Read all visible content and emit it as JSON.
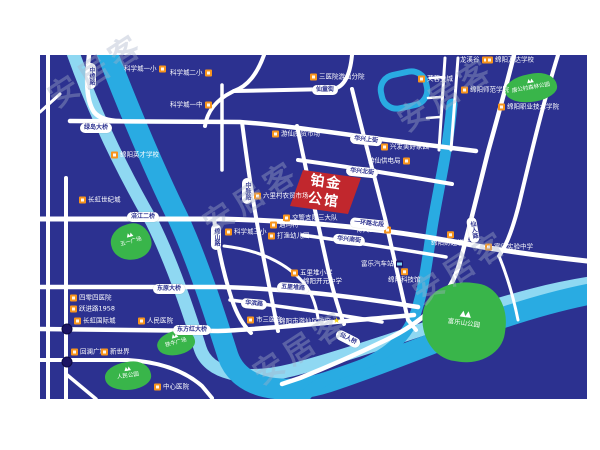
{
  "watermark": {
    "text": "安居客",
    "angle": -33,
    "positions": [
      [
        95,
        68
      ],
      [
        445,
        92
      ],
      [
        250,
        195
      ],
      [
        460,
        265
      ],
      [
        300,
        345
      ]
    ]
  },
  "project": {
    "line1": "铂金",
    "line2": "公馆",
    "color": "#C1272D",
    "points": "303,170 361,178 348,214 290,206",
    "cx": 325,
    "cy": 192,
    "rotate": 8
  },
  "map": {
    "colors": {
      "bg": "#2C3190",
      "road": "#FFFFFF",
      "river": "#29ABE2",
      "river_light": "#8FD8F2",
      "park": "#39B54A",
      "poi_icon": "#F7941D",
      "marker_dot": "#1B1464",
      "project_red": "#C1272D",
      "pill_text": "#2C3190",
      "star": "#F7D51D"
    },
    "rivers": [
      {
        "name": "涪江浅带",
        "color": "#8FD8F2",
        "w": 13,
        "path": "M 72,50 C 95,115 122,170 152,222 C 170,258 186,303 200,348 C 208,374 244,382 292,370 C 352,354 416,331 478,311 C 518,298 552,289 590,283"
      },
      {
        "name": "涪江",
        "color": "#29ABE2",
        "w": 21,
        "path": "M 106,50 C 130,112 152,165 178,218 C 198,262 214,312 228,356 C 240,390 284,396 328,382 C 380,365 434,342 490,322 C 530,308 560,300 590,294"
      },
      {
        "name": "芙蓉溪",
        "color": "#29ABE2",
        "w": 11,
        "path": "M 452,104 C 448,150 438,190 432,228 C 427,262 424,288 416,312 C 405,344 378,360 344,372 C 322,380 308,390 303,400"
      }
    ],
    "lake": {
      "cx": 404,
      "cy": 90,
      "w": 46,
      "h": 34,
      "rx": 15,
      "rotate": -12,
      "stroke": "#29ABE2",
      "sw": 6
    },
    "roads": [
      {
        "name": "滨江纵路",
        "w": 4,
        "path": "M 48,55 V 399"
      },
      {
        "name": "临园纵路",
        "w": 4,
        "path": "M 66,178 V 399"
      },
      {
        "name": "左上斜路",
        "w": 3,
        "path": "M 40,112 L 60,94"
      },
      {
        "name": "中绵路",
        "w": 4.5,
        "path": "M 89,55 C 86,80 86,100 94,112 C 99,118 108,121 120,121"
      },
      {
        "name": "绿岛大桥-华兴上街",
        "w": 4.5,
        "path": "M 70,121 L 240,122 C 280,125 330,132 380,139 C 420,144 452,148 476,151"
      },
      {
        "name": "仙童街西",
        "w": 4,
        "path": "M 264,55 C 257,74 248,86 234,91 L 232,92 C 216,100 207,112 205,126"
      },
      {
        "name": "仙童街东",
        "w": 4,
        "path": "M 234,91 L 332,89 C 344,88 350,76 352,55"
      },
      {
        "name": "科学城纵路",
        "w": 3.5,
        "path": "M 222,85 L 222,170"
      },
      {
        "name": "绵山路",
        "w": 4,
        "path": "M 214,219 C 218,250 224,275 232,300 C 237,315 243,325 251,333"
      },
      {
        "name": "中脉路",
        "w": 4,
        "path": "M 242,122 C 248,170 255,215 263,255 C 268,280 273,305 278,331"
      },
      {
        "name": "项目西路",
        "w": 4,
        "path": "M 297,126 C 306,170 316,215 326,260 C 332,288 338,308 344,324"
      },
      {
        "name": "项目东路",
        "w": 4,
        "path": "M 352,89 C 362,130 374,175 385,218 C 392,248 400,285 408,320 L 416,330"
      },
      {
        "name": "华兴北街",
        "w": 4,
        "path": "M 298,160 C 350,167 405,176 452,184"
      },
      {
        "name": "一环路北段",
        "w": 5,
        "path": "M 40,219 L 222,219 C 310,221 390,229 472,245 C 510,252 550,257 587,261"
      },
      {
        "name": "华兴南街",
        "w": 3.5,
        "path": "M 302,235 C 352,242 400,249 446,257"
      },
      {
        "name": "五里堆路",
        "w": 4.5,
        "path": "M 40,287 L 222,287 C 290,289 350,296 418,307"
      },
      {
        "name": "华滨路",
        "w": 3.5,
        "path": "M 230,300 C 280,306 330,313 382,322"
      },
      {
        "name": "东方红大桥路",
        "w": 4.5,
        "path": "M 40,329 L 218,331 C 270,329 330,322 392,317 L 414,315"
      },
      {
        "name": "滨河南路",
        "w": 4,
        "path": "M 40,360 L 128,360 C 162,362 186,372 202,386 L 212,398"
      },
      {
        "name": "左下斜路",
        "w": 3.5,
        "path": "M 66,374 L 96,399"
      },
      {
        "name": "科三小弯路",
        "w": 3,
        "path": "M 224,246 C 258,250 285,262 303,282 C 312,292 316,305 318,318"
      },
      {
        "name": "仙人路",
        "w": 4.5,
        "path": "M 514,55 C 504,95 494,130 488,152 C 478,192 470,225 460,262 C 450,298 424,320 392,337 C 362,352 330,366 300,378 L 282,384"
      },
      {
        "name": "梯路西",
        "w": 3,
        "path": "M 445,58 L 439,150"
      },
      {
        "name": "梯路东",
        "w": 3,
        "path": "M 458,58 L 451,150"
      },
      {
        "name": "梯横1",
        "w": 2.5,
        "path": "M 430,78 L 444,77"
      },
      {
        "name": "梯横2",
        "w": 2.5,
        "path": "M 428,98 L 442,97"
      },
      {
        "name": "梯横3",
        "w": 2.5,
        "path": "M 427,118 L 440,117"
      },
      {
        "name": "东侧斜路",
        "w": 4,
        "path": "M 558,55 C 544,100 532,150 521,196 C 514,226 507,245 499,256"
      },
      {
        "name": "富乐支路",
        "w": 3,
        "path": "M 499,256 C 508,278 514,300 518,320"
      }
    ],
    "pills": [
      {
        "t": "绿岛大桥",
        "x": 96,
        "y": 128,
        "v": false,
        "a": 0
      },
      {
        "t": "中绵路",
        "x": 91,
        "y": 76,
        "v": true,
        "a": 0
      },
      {
        "t": "仙童街",
        "x": 325,
        "y": 90,
        "v": false,
        "a": 0
      },
      {
        "t": "华兴上街",
        "x": 366,
        "y": 140,
        "v": false,
        "a": 6
      },
      {
        "t": "华兴北街",
        "x": 362,
        "y": 172,
        "v": false,
        "a": 6
      },
      {
        "t": "一环路北段",
        "x": 369,
        "y": 224,
        "v": false,
        "a": 6
      },
      {
        "t": "华兴南街",
        "x": 349,
        "y": 240,
        "v": false,
        "a": 6
      },
      {
        "t": "五里堆路",
        "x": 293,
        "y": 288,
        "v": false,
        "a": 4
      },
      {
        "t": "华滨路",
        "x": 254,
        "y": 304,
        "v": false,
        "a": 5
      },
      {
        "t": "涪江二桥",
        "x": 143,
        "y": 217,
        "v": false,
        "a": 0
      },
      {
        "t": "东原大桥",
        "x": 169,
        "y": 289,
        "v": false,
        "a": 0
      },
      {
        "t": "东方红大桥",
        "x": 192,
        "y": 330,
        "v": false,
        "a": 0
      },
      {
        "t": "绵山路",
        "x": 216,
        "y": 237,
        "v": true,
        "a": 0
      },
      {
        "t": "中脉路",
        "x": 247,
        "y": 191,
        "v": true,
        "a": 0
      },
      {
        "t": "仙人路",
        "x": 473,
        "y": 230,
        "v": true,
        "a": -10
      },
      {
        "t": "仙人桥",
        "x": 348,
        "y": 339,
        "v": false,
        "a": 27
      }
    ],
    "pois": [
      {
        "t": "科学城一小",
        "x": 124,
        "y": 69,
        "side": "right",
        "kind": "orange"
      },
      {
        "t": "科学城二小",
        "x": 170,
        "y": 73,
        "side": "right",
        "kind": "orange"
      },
      {
        "t": "科学城一中",
        "x": 170,
        "y": 105,
        "side": "right",
        "kind": "orange"
      },
      {
        "t": "绵阳英才学校",
        "x": 111,
        "y": 155,
        "side": "left",
        "kind": "orange"
      },
      {
        "t": "长虹世纪城",
        "x": 79,
        "y": 200,
        "side": "left",
        "kind": "orange"
      },
      {
        "t": "四零四医院",
        "x": 70,
        "y": 298,
        "side": "left",
        "kind": "orange"
      },
      {
        "t": "跃进路1958",
        "x": 70,
        "y": 309,
        "side": "left",
        "kind": "orange"
      },
      {
        "t": "长虹国际城",
        "x": 74,
        "y": 321,
        "side": "left",
        "kind": "orange"
      },
      {
        "t": "人民医院",
        "x": 138,
        "y": 321,
        "side": "left",
        "kind": "orange"
      },
      {
        "t": "回澜广场",
        "x": 71,
        "y": 352,
        "side": "left",
        "kind": "orange"
      },
      {
        "t": "新世界",
        "x": 101,
        "y": 352,
        "side": "left",
        "kind": "orange"
      },
      {
        "t": "中心医院",
        "x": 154,
        "y": 387,
        "side": "left",
        "kind": "orange"
      },
      {
        "t": "三医院游仙分院",
        "x": 310,
        "y": 77,
        "side": "left",
        "kind": "orange"
      },
      {
        "t": "游仙庆贸市场",
        "x": 272,
        "y": 134,
        "side": "left",
        "kind": "orange"
      },
      {
        "t": "兴发美好家园",
        "x": 381,
        "y": 147,
        "side": "left",
        "kind": "orange"
      },
      {
        "t": "游仙供电局",
        "x": 368,
        "y": 161,
        "side": "right",
        "kind": "orange"
      },
      {
        "t": "六里村农贸市场",
        "x": 254,
        "y": 196,
        "side": "left",
        "kind": "orange"
      },
      {
        "t": "交警支队三大队",
        "x": 283,
        "y": 218,
        "side": "left",
        "kind": "orange"
      },
      {
        "t": "遇玛特",
        "x": 270,
        "y": 225,
        "side": "left",
        "kind": "orange"
      },
      {
        "t": "科学城三小",
        "x": 225,
        "y": 232,
        "side": "left",
        "kind": "orange"
      },
      {
        "t": "打渔幼儿园",
        "x": 268,
        "y": 236,
        "side": "left",
        "kind": "orange"
      },
      {
        "t": "五里堆小学",
        "x": 291,
        "y": 273,
        "side": "left",
        "kind": "orange"
      },
      {
        "t": "绵阳开元中学",
        "x": 303,
        "y": 281,
        "side": "none",
        "kind": "orange"
      },
      {
        "t": "博大医院",
        "x": 356,
        "y": 230,
        "side": "right",
        "kind": "orange"
      },
      {
        "t": "富乐汽车站",
        "x": 361,
        "y": 264,
        "side": "right",
        "kind": "bus"
      },
      {
        "t": "绵阳科技馆",
        "x": 388,
        "y": 277,
        "side": "above",
        "kind": "orange"
      },
      {
        "t": "市三医院",
        "x": 247,
        "y": 320,
        "side": "left",
        "kind": "orange"
      },
      {
        "t": "绵阳市游仙区政府",
        "x": 279,
        "y": 321,
        "side": "star",
        "kind": "star"
      },
      {
        "t": "龙溪谷",
        "x": 460,
        "y": 60,
        "side": "right",
        "kind": "orange"
      },
      {
        "t": "绵阳万达学校",
        "x": 486,
        "y": 60,
        "side": "left",
        "kind": "orange"
      },
      {
        "t": "芙蓉金城",
        "x": 418,
        "y": 79,
        "side": "left",
        "kind": "orange"
      },
      {
        "t": "绵阳师范学院",
        "x": 461,
        "y": 90,
        "side": "left",
        "kind": "orange"
      },
      {
        "t": "绵阳职业技术学院",
        "x": 498,
        "y": 107,
        "side": "left",
        "kind": "orange"
      },
      {
        "t": "绵阳财经学校",
        "x": 431,
        "y": 240,
        "side": "above",
        "kind": "orange"
      },
      {
        "t": "富乐实验中学",
        "x": 485,
        "y": 247,
        "side": "left",
        "kind": "orange"
      }
    ],
    "parks": [
      {
        "name": "五一广场",
        "x": 131,
        "y": 242,
        "w": 40,
        "h": 36,
        "rot": -15,
        "fs": 5.5,
        "tree_fs": 5,
        "radius": "55% 45% 50% 60% / 50% 60% 45% 55%"
      },
      {
        "name": "铁牛广场",
        "x": 176,
        "y": 343,
        "w": 38,
        "h": 24,
        "rot": -15,
        "fs": 5.5,
        "tree_fs": 5,
        "radius": "55% 45% 50% 60% / 50% 60% 45% 55%"
      },
      {
        "name": "人民公园",
        "x": 128,
        "y": 376,
        "w": 46,
        "h": 28,
        "rot": -8,
        "fs": 5.5,
        "tree_fs": 5,
        "radius": "55% 45% 50% 60% / 50% 60% 45% 55%"
      },
      {
        "name": "富乐山公园",
        "x": 464,
        "y": 322,
        "w": 84,
        "h": 80,
        "rot": 8,
        "fs": 6.5,
        "tree_fs": 8,
        "radius": "58% 42% 52% 48% / 48% 55% 45% 58%"
      },
      {
        "name": "唐公村森林公园",
        "x": 531,
        "y": 88,
        "w": 52,
        "h": 28,
        "rot": -10,
        "fs": 5.5,
        "tree_fs": 5,
        "radius": "55% 45% 50% 60% / 50% 60% 45% 55%"
      }
    ],
    "dots": [
      {
        "x": 67,
        "y": 329
      },
      {
        "x": 67,
        "y": 362
      }
    ]
  }
}
